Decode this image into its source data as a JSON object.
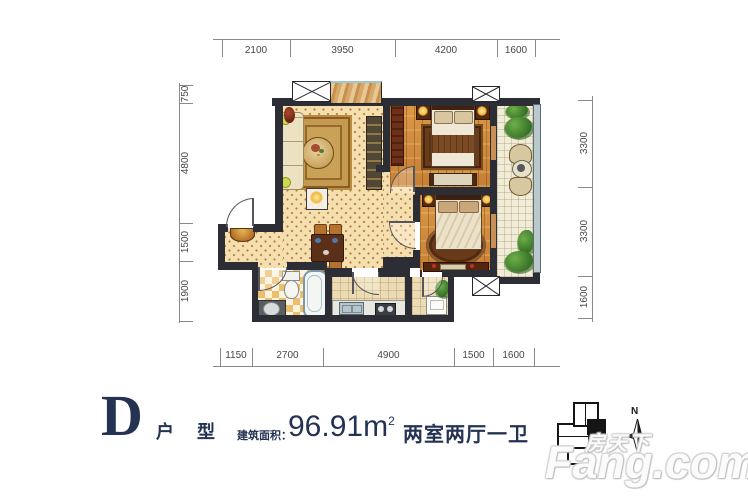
{
  "title": {
    "letter": "D",
    "type_label": "户 型",
    "area_label": "建筑面积：",
    "area_value": "96.91m",
    "area_sup": "2",
    "layout_text": "两室两厅一卫"
  },
  "dimensions": {
    "top": [
      "2100",
      "3950",
      "4200",
      "1600"
    ],
    "bottom": [
      "1150",
      "2700",
      "4900",
      "1500",
      "1600"
    ],
    "left": [
      "750",
      "4800",
      "1500",
      "1900"
    ],
    "right": [
      "3300",
      "3300",
      "1600"
    ]
  },
  "compass": {
    "north_label": "N"
  },
  "watermark": {
    "cn": "房天下",
    "en": "Fang.com"
  },
  "colors": {
    "wall": "#2c2d35",
    "title_navy": "#243352",
    "living_floor": "#f6dfae",
    "bedroom_floor": "#d28d3c",
    "balcony_floor": "#f1ecd8",
    "bath_tile": "#ecbe6e"
  }
}
